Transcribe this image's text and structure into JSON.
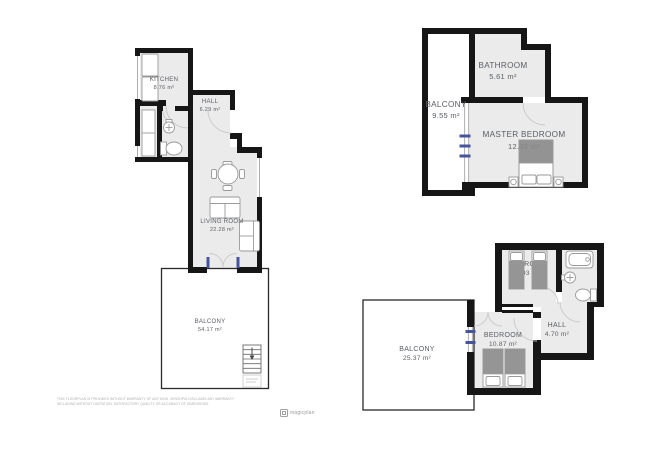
{
  "document_type": "floor-plan",
  "colors": {
    "wall": "#161616",
    "room_floor": "#ebebeb",
    "furniture_stroke": "#9a9a9a",
    "bed_fill": "#8a8a8a",
    "door_arc": "#c9c9c9",
    "window_accent_blue": "#46549e",
    "label_text": "#5a5e63"
  },
  "plans": [
    {
      "id": "plan-left",
      "rooms": [
        {
          "name": "KITCHEN",
          "area": "8.76 m²"
        },
        {
          "name": "HALL",
          "area": "6.29 m²"
        },
        {
          "name": "LIVING ROOM",
          "area": "22.28 m²"
        },
        {
          "name": "BALCONY",
          "area": "54.17 m²"
        }
      ]
    },
    {
      "id": "plan-top-right",
      "rooms": [
        {
          "name": "BALCONY",
          "area": "9.55 m²"
        },
        {
          "name": "BATHROOM",
          "area": "5.61 m²"
        },
        {
          "name": "MASTER BEDROOM",
          "area": "12.38 m²"
        }
      ]
    },
    {
      "id": "plan-bottom-right",
      "rooms": [
        {
          "name": "BEDROOM",
          "area": "7.93 m²"
        },
        {
          "name": "HALL",
          "area": "4.70 m²"
        },
        {
          "name": "BEDROOM",
          "area": "10.87 m²"
        },
        {
          "name": "BALCONY",
          "area": "25.37 m²"
        }
      ]
    }
  ],
  "footer": {
    "disclaimer_line1": "THIS FLOORPLAN IS PROVIDED WITHOUT WARRANTY OF ANY KIND. SENSOPIA DISCLAIMS ANY WARRANTY",
    "disclaimer_line2": "INCLUDING WITHOUT LIMITATION, SATISFACTORY QUALITY OR ACCURACY OF DIMENSIONS.",
    "logo_text": "magicplan"
  }
}
